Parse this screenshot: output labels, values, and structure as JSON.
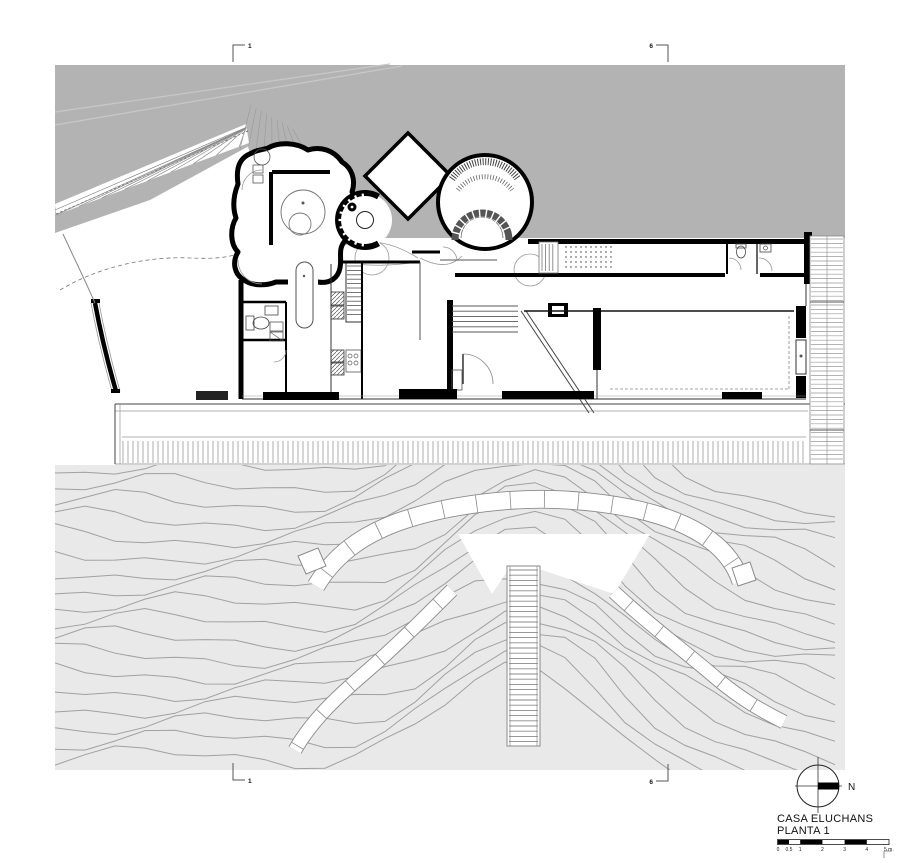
{
  "document": {
    "kind": "architectural-floor-plan"
  },
  "title_block": {
    "project": "CASA ELUCHANS",
    "sheet": "PLANTA 1"
  },
  "north_indicator": {
    "label": "N"
  },
  "scale_bar": {
    "ticks": [
      "0",
      "0.5",
      "1",
      "2",
      "3",
      "4",
      "5 m."
    ]
  },
  "section_markers": {
    "top_left": "1",
    "top_right": "6",
    "bottom_left": "1",
    "bottom_right": "6"
  },
  "colors": {
    "hill_gray": "#b3b3b3",
    "terrain_gray": "#e9e9e9",
    "contour_line": "#a0a0a0",
    "ink": "#000000",
    "line_mid": "#555555",
    "line_light": "#8a8a8a",
    "hatch": "#999999",
    "white": "#ffffff"
  }
}
